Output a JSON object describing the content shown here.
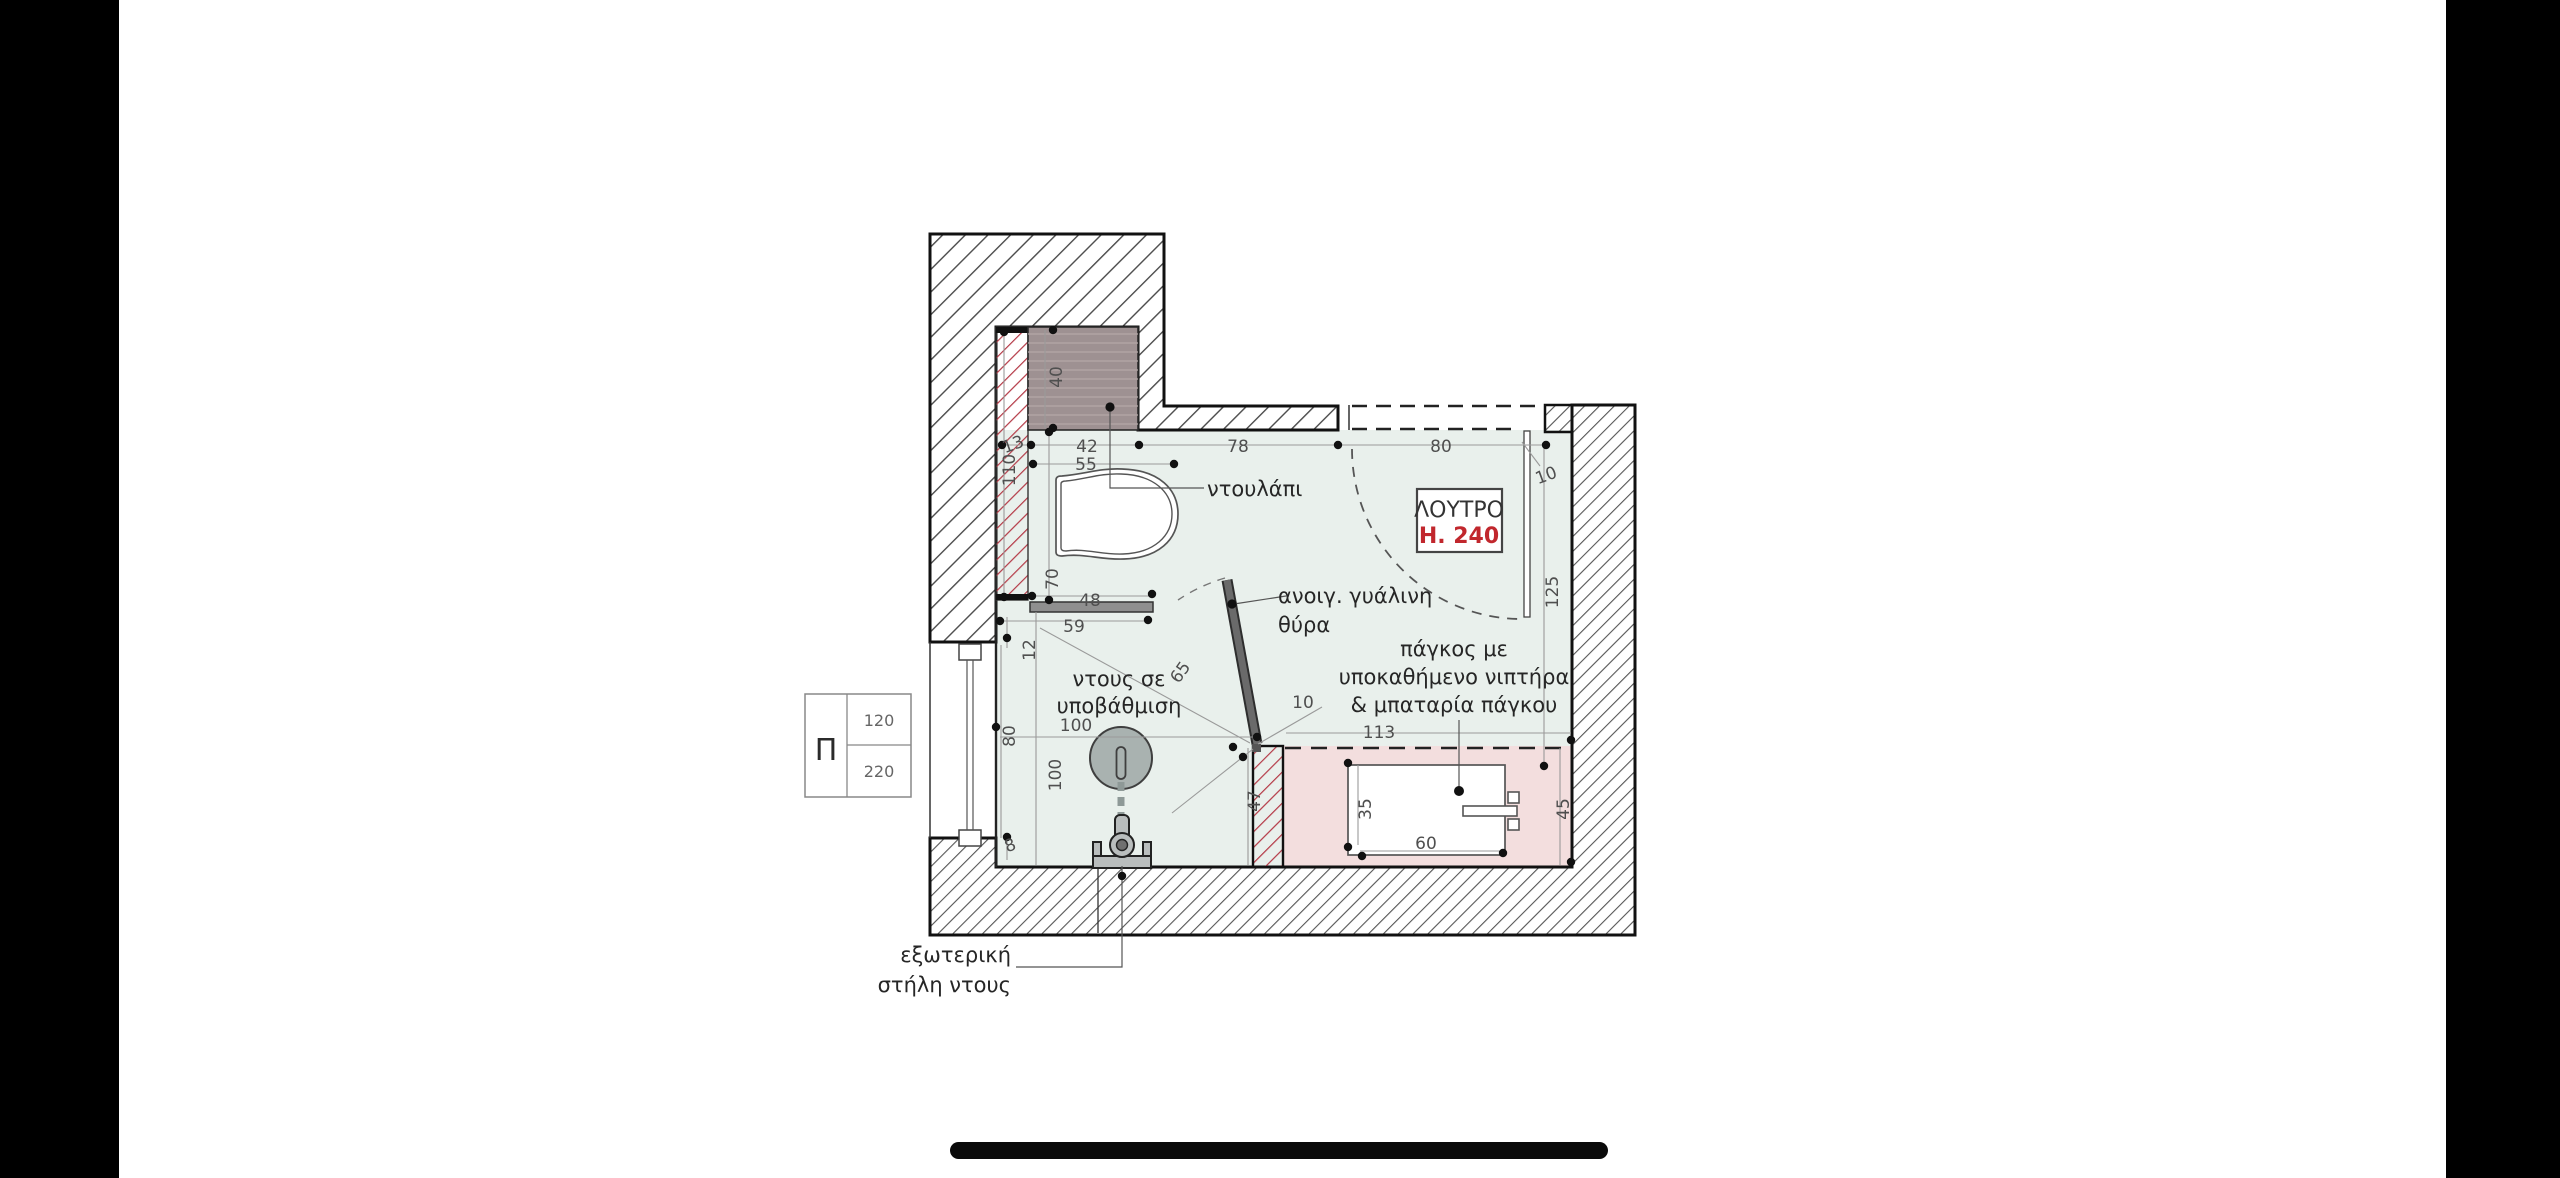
{
  "page": {
    "background": "#000000",
    "canvas": "#ffffff"
  },
  "plan": {
    "room_tag": {
      "name": "ΛΟΥΤΡΟ",
      "height": "H. 240"
    },
    "labels": {
      "closet": "ντουλάπι",
      "door_line1": "ανοιγ. γυάλινη",
      "door_line2": "θύρα",
      "shower_line1": "ντους σε",
      "shower_line2": "υποβάθμιση",
      "counter_line1": "πάγκος με",
      "counter_line2": "υποκαθήμενο νιπτήρα",
      "counter_line3": "& μπαταρία πάγκου",
      "ext_shower_line1": "εξωτερική",
      "ext_shower_line2": "στήλη ντους"
    },
    "legend": {
      "symbol": "Π",
      "top_value": "120",
      "bottom_value": "220"
    },
    "dimensions": {
      "closet_depth": "40",
      "wall_13": "13",
      "wall_110": "110",
      "closet_42": "42",
      "wc_55": "55",
      "top_78": "78",
      "top_80": "80",
      "right_10": "10",
      "right_125": "125",
      "wc_70": "70",
      "ledge_48": "48",
      "ledge_59": "59",
      "step_12": "12",
      "window_80": "80",
      "shower_100_h": "100",
      "shower_100_v": "100",
      "step_8": "8",
      "diag_65": "65",
      "door_10": "10",
      "counter_113": "113",
      "wall_47": "47",
      "sink_35": "35",
      "sink_60": "60",
      "counter_45": "45"
    },
    "colors": {
      "floor": "#e9f0ec",
      "counter": "#f3dede",
      "closet": "#9e9192",
      "red_hatch": "#b43946",
      "accent_red": "#c1272d",
      "door": "#5f5f5f",
      "shower": "#a9b2b0"
    }
  }
}
